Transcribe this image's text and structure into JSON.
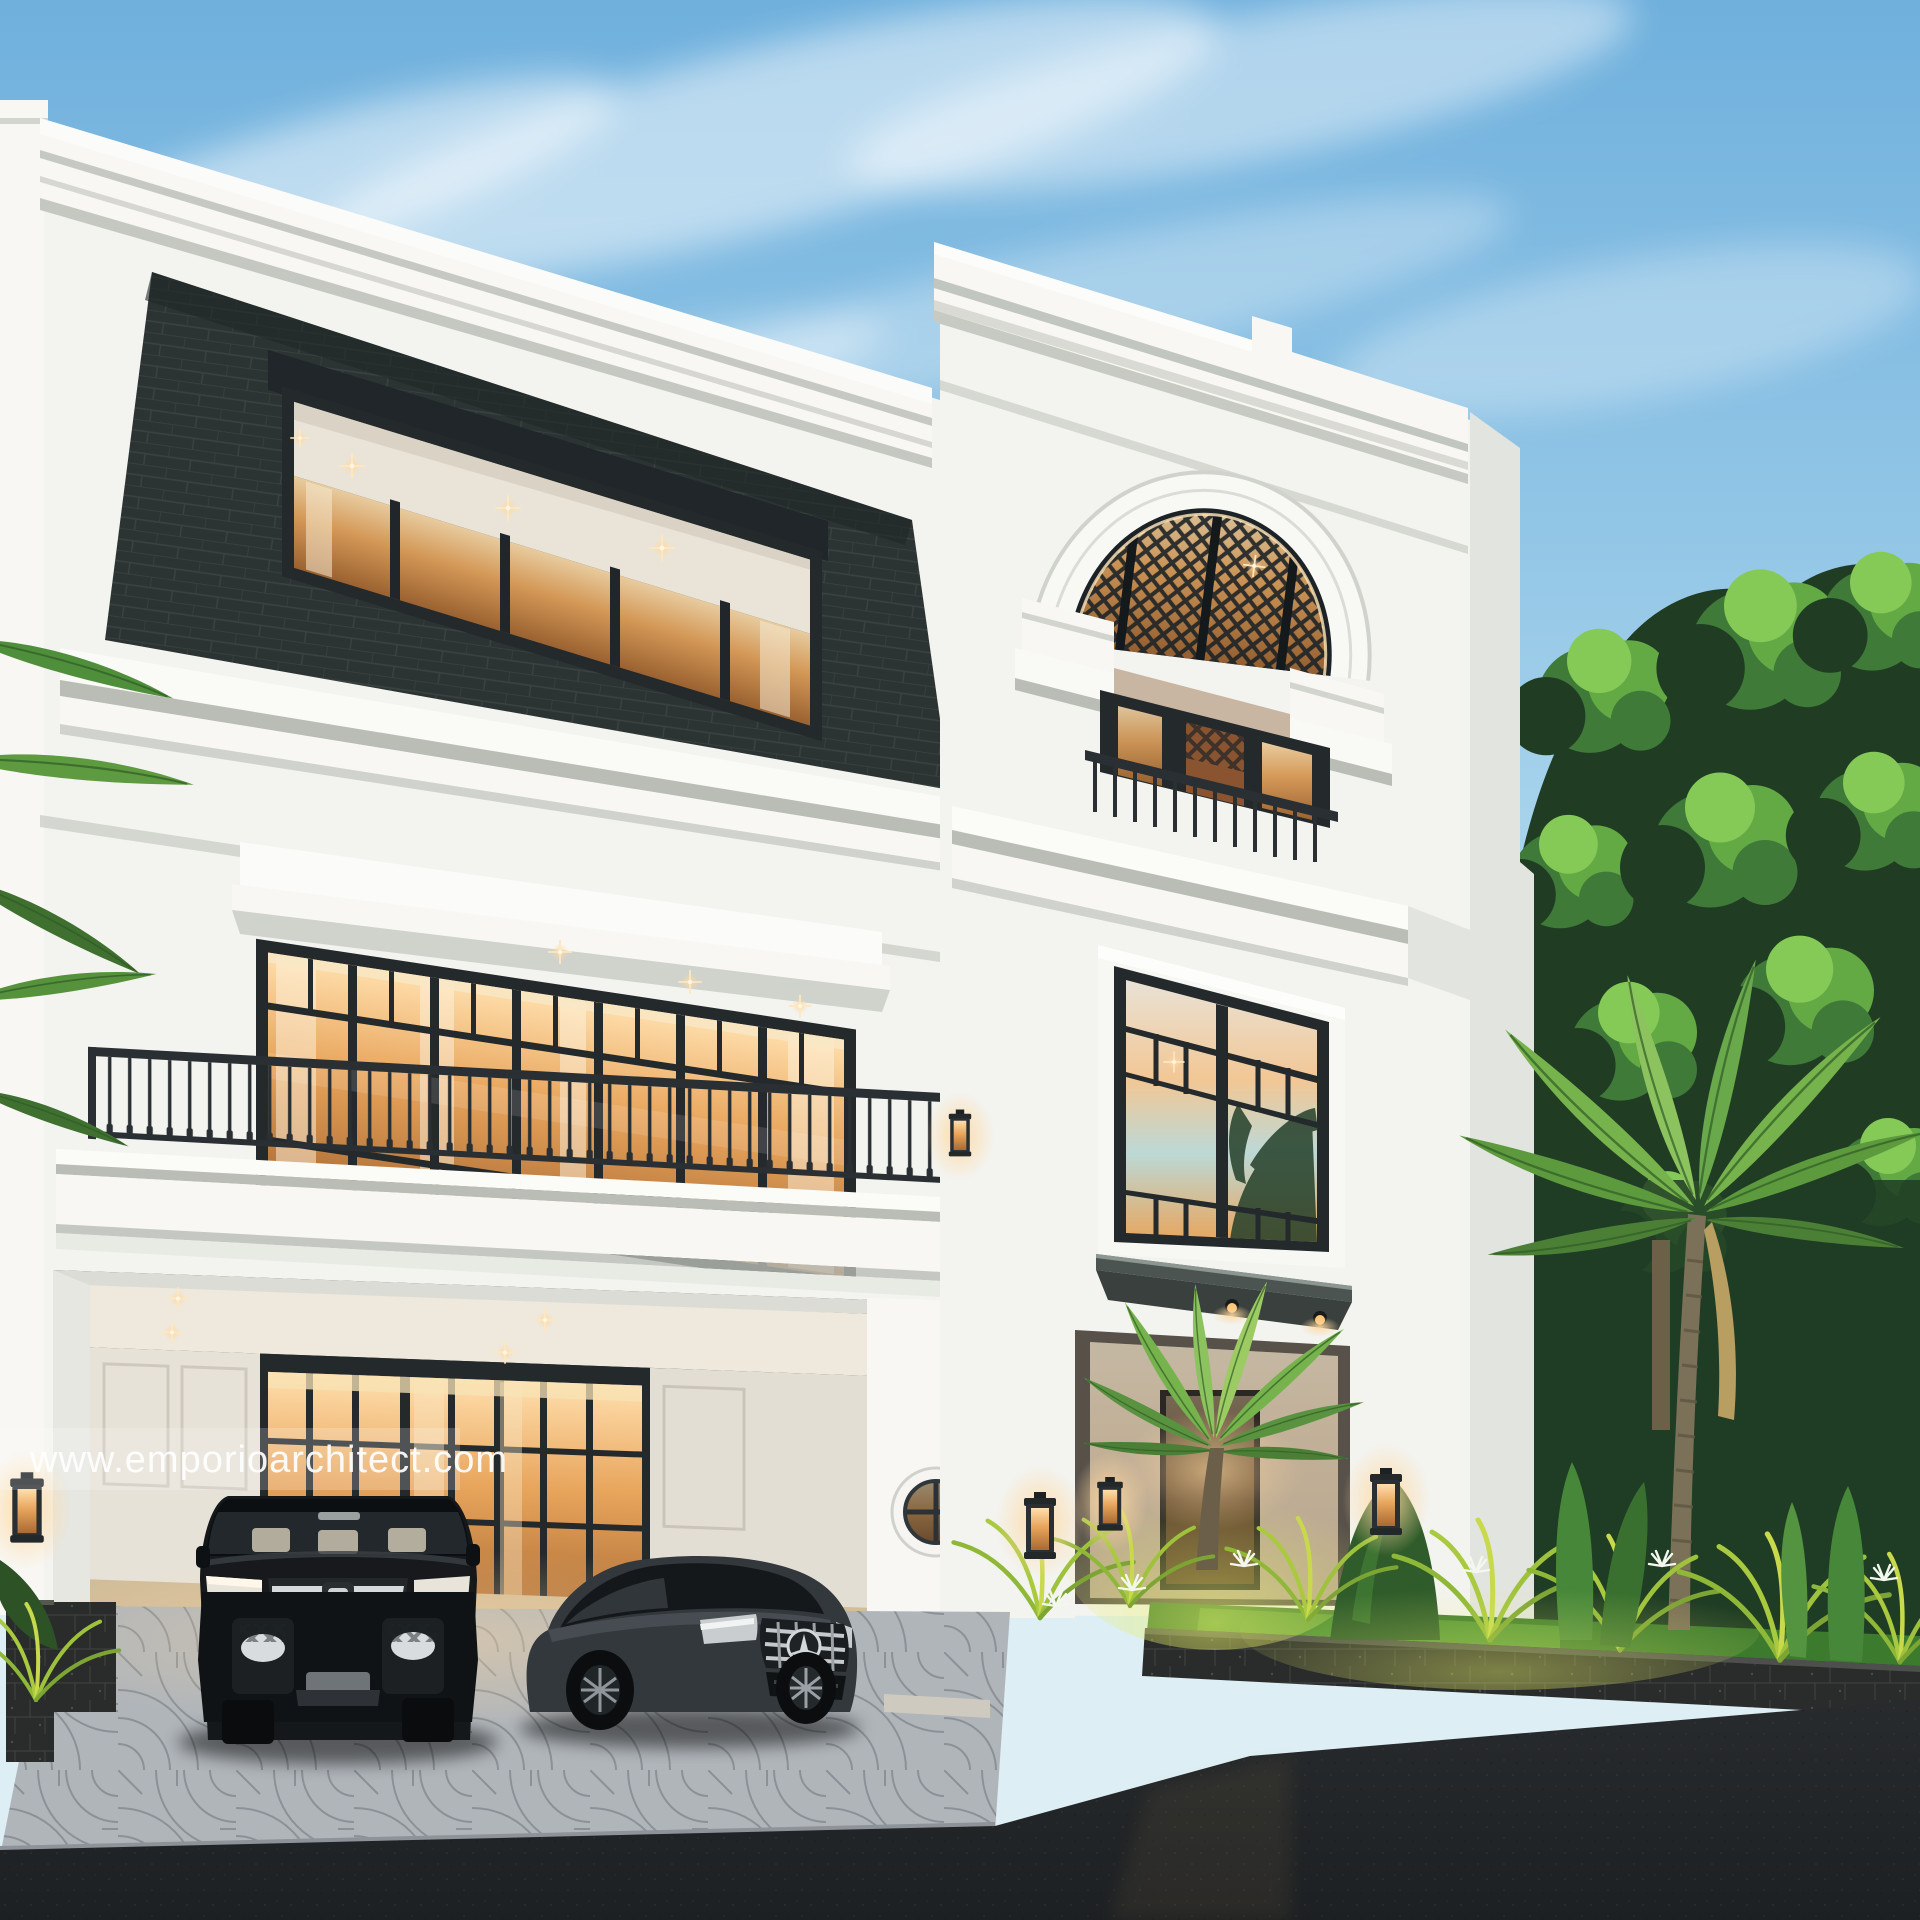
{
  "meta": {
    "type": "architectural-3d-render",
    "subject": "Three-storey classic luxury private house facade at dusk with carport, two cars and tropical landscaping"
  },
  "watermark": {
    "text": "www.emporioarchitect.com"
  },
  "scene": {
    "time_of_day": "dusk",
    "elements": [
      "sky-with-cloud-streaks",
      "left-block-facade",
      "mansard-slate-roof",
      "mansard-ribbon-window",
      "second-floor-glass-wall",
      "projecting-window-hood",
      "wrought-iron-balcony",
      "carport",
      "glass-sliding-doors",
      "porthole-window",
      "entry-tower-facade",
      "arched-lattice-window",
      "juliet-balcony",
      "tall-entry-window",
      "dark-entry-canopy",
      "entrance-porch",
      "entrance-palm",
      "right-tree-canopy",
      "tall-palm-tree",
      "tropical-garden-bed",
      "lava-stone-planter-wall",
      "fan-pattern-paver-driveway",
      "asphalt-road",
      "wall-lanterns",
      "recessed-downlights"
    ],
    "vehicles": [
      {
        "name": "black-luxury-mpv",
        "description": "black Toyota Alphard-style van with chrome grille"
      },
      {
        "name": "graphite-coupe",
        "description": "dark grey Mercedes-style coupe with star grille"
      }
    ],
    "lighting": "warm interior glow, garden uplights, recessed ceiling downlights"
  },
  "colors": {
    "sky_top": "#6fb0dd",
    "sky_mid": "#a9d4ec",
    "sky_low": "#ddeef4",
    "cloud": "#ffffff",
    "wall_white": "#f3f3ef",
    "wall_lit": "#f8f7f3",
    "wall_shade": "#e2e4df",
    "wall_dim": "#d4d7d1",
    "cornice_shadow": "#b9bdb6",
    "mansard_dark": "#2c3433",
    "mansard_line": "#3a4341",
    "frame_dark": "#24292c",
    "frame_mid": "#3a4144",
    "glass_warm": "#e8a55c",
    "glass_warm_deep": "#a96a33",
    "glass_hot": "#ffdfad",
    "glass_sunset": "#f2c795",
    "glass_cool": "#bcd9d6",
    "ceiling_warm": "#efe8dc",
    "railing_dark": "#2a2f33",
    "canopy_dark": "#39403d",
    "canopy_face": "#4b5450",
    "lava_stone": "#2a2c2b",
    "lava_line": "#3d403e",
    "paver_light": "#bcc1c7",
    "paver_line": "#878d95",
    "paver_warm": "#d2bd9a",
    "road_dark": "#282b2d",
    "road_deep": "#1d2022",
    "lawn_green": "#3c7a2d",
    "lawn_lit": "#5a9c3a",
    "foliage_dark": "#203d24",
    "foliage_mid": "#3f7a38",
    "foliage_light": "#63aa45",
    "foliage_bright": "#85c956",
    "uplight_green": "#c8d94c",
    "trunk_brown": "#7b7058",
    "lantern_glow": "#ffc578",
    "interior_white": "#eae4d8",
    "watermark_ink": "#ffffff"
  }
}
